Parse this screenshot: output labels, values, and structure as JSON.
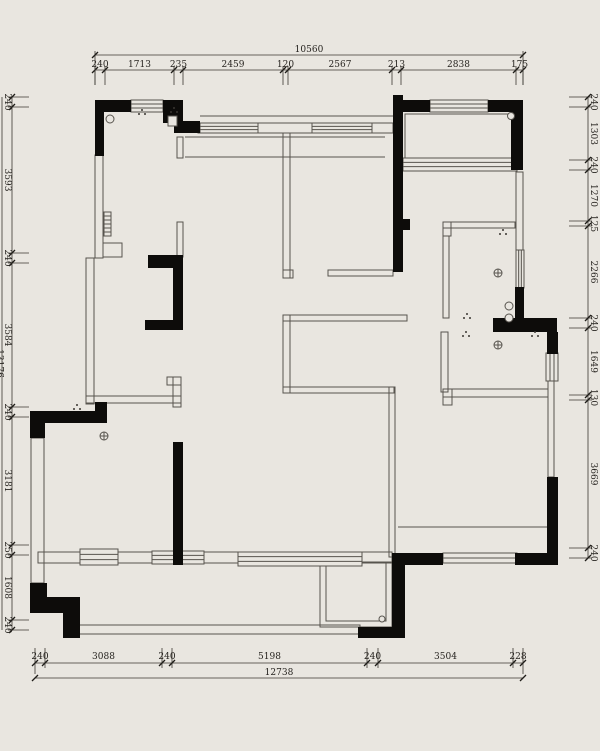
{
  "drawing": {
    "type": "architectural-floor-plan",
    "colors": {
      "background": "#e9e6e0",
      "wall": "#0d0c0a",
      "line": "#57544e",
      "dimension_text": "#26231f"
    }
  },
  "dimensions": {
    "top": {
      "total": "10560",
      "labels": [
        "240",
        "1713",
        "235",
        "2459",
        "120",
        "2567",
        "213",
        "2838",
        "175"
      ],
      "ticks": [
        95,
        105,
        174,
        183,
        283,
        288,
        392,
        401,
        516,
        523
      ]
    },
    "bottom": {
      "total": "12738",
      "labels": [
        "240",
        "3088",
        "240",
        "5198",
        "240",
        "3504",
        "228"
      ],
      "ticks": [
        35,
        45,
        162,
        172,
        367,
        378,
        513,
        523
      ]
    },
    "left": {
      "total": "13176",
      "labels": [
        "240",
        "3593",
        "240",
        "3584",
        "240",
        "3181",
        "250",
        "1608",
        "240"
      ],
      "ticks": [
        97,
        107,
        253,
        263,
        407,
        417,
        545,
        555,
        620,
        630
      ]
    },
    "right": {
      "labels": [
        "240",
        "1303",
        "240",
        "1270",
        "125",
        "2266",
        "240",
        "1649",
        "130",
        "3669",
        "240"
      ],
      "ticks": [
        97,
        107,
        160,
        170,
        221,
        226,
        318,
        328,
        395,
        400,
        548,
        558
      ]
    }
  }
}
